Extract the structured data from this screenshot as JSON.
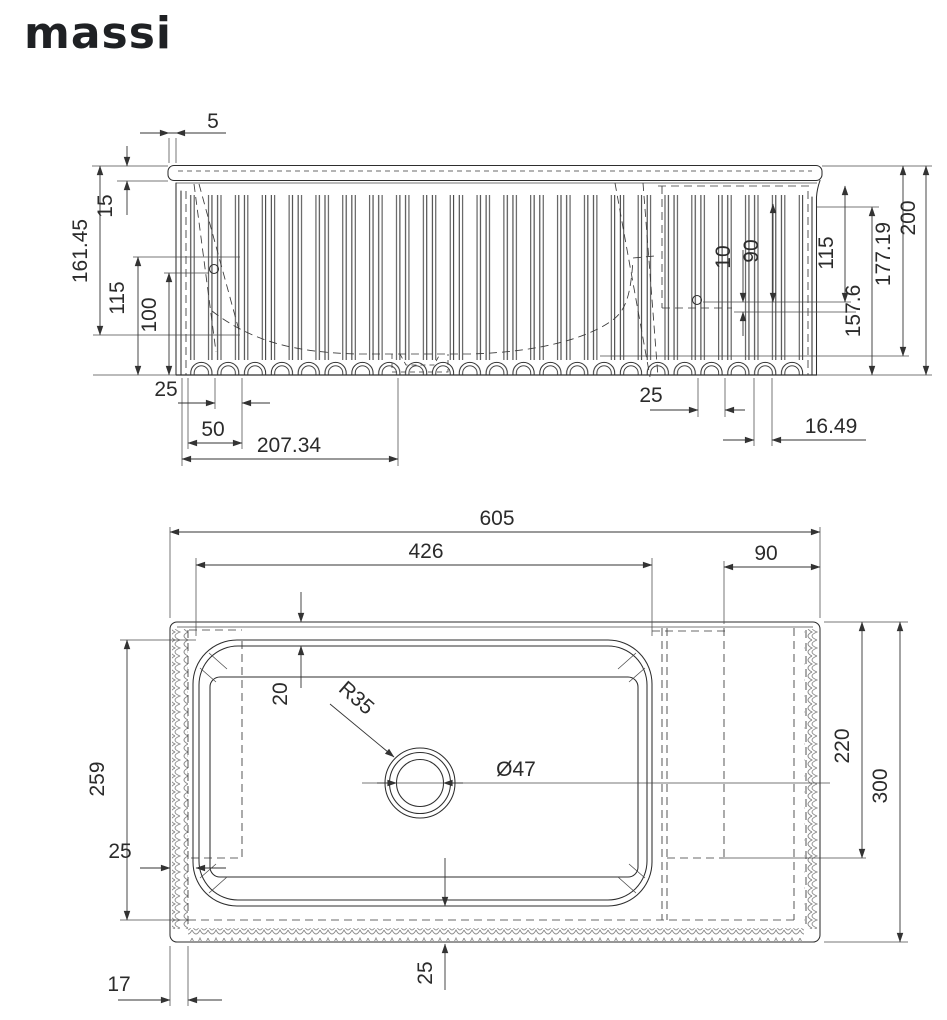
{
  "brand": {
    "logo_text": "massi"
  },
  "front_view": {
    "dims": {
      "rim_overhang": "5",
      "rim_height": "15",
      "height_to_shelf": "161.45",
      "hole_height_a": "115",
      "hole_height_b": "100",
      "flute_pitch": "25",
      "flute_pitch_double": "50",
      "drain_offset": "207.34",
      "deck_hole_offset": "10",
      "deck_hole_height": "90",
      "deck_height": "115",
      "body_height": "157.6",
      "flute_height": "177.19",
      "total_height": "200",
      "flute_pitch_right": "25",
      "edge_offset": "16.49"
    }
  },
  "plan_view": {
    "dims": {
      "total_width": "605",
      "basin_width": "426",
      "deck_width": "90",
      "rim_inset": "20",
      "corner_radius": "R35",
      "drain_diameter": "Ø47",
      "basin_depth": "259",
      "deck_depth": "220",
      "total_depth": "300",
      "front_wall": "25",
      "side_wall": "17",
      "left_wall": "25"
    }
  }
}
